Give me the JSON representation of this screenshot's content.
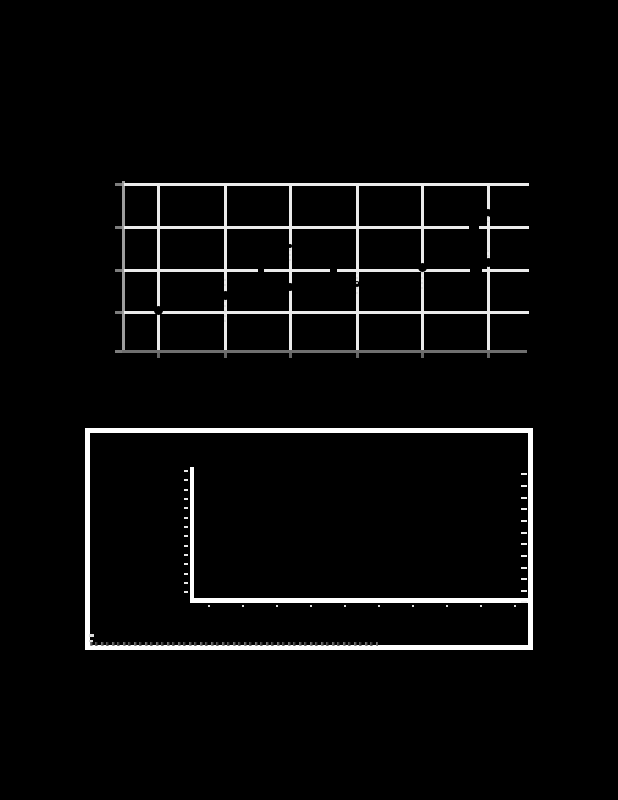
{
  "page": {
    "background": "#000000",
    "width": 618,
    "height": 800,
    "visible_text": "none — all labels are illegible (rendered black on black); only plot graphics are visible"
  },
  "figure1": {
    "name": "top-grid-chart",
    "plot_area": {
      "x": 122,
      "y": 181,
      "w": 405,
      "h": 172
    },
    "colors": {
      "gridline": "#ebebeb",
      "spine_left": "#9e9e9e",
      "spine_bottom": "#6f6f6f",
      "tick_left": "#7d7d7d",
      "tick_bottom": "#666666",
      "marker": "#000000",
      "dash_remnant": "#d8d8d8"
    },
    "h_gridlines_y": [
      183,
      226,
      269,
      311
    ],
    "v_gridlines_x": [
      157,
      224,
      289,
      356,
      421,
      487
    ],
    "left_spine": {
      "x": 122,
      "y": 181,
      "w": 3,
      "h": 172
    },
    "bottom_spine": {
      "x": 122,
      "y": 350,
      "w": 405,
      "h": 3
    },
    "left_ticks_y": [
      183,
      226,
      269,
      311,
      350
    ],
    "bottom_ticks_x": [
      157,
      224,
      289,
      356,
      421,
      487
    ],
    "marker_dots": [
      {
        "x": 158,
        "y": 310,
        "d": 9
      },
      {
        "x": 225,
        "y": 295,
        "d": 9
      },
      {
        "x": 290,
        "y": 287,
        "d": 8
      },
      {
        "x": 290,
        "y": 246,
        "d": 4
      },
      {
        "x": 357,
        "y": 284,
        "d": 6
      },
      {
        "x": 422,
        "y": 267,
        "d": 9
      },
      {
        "x": 488,
        "y": 262,
        "d": 9
      },
      {
        "x": 488,
        "y": 213,
        "d": 8
      }
    ],
    "line_nicks": [
      {
        "x": 469,
        "y": 224,
        "w": 10,
        "h": 5
      },
      {
        "x": 470,
        "y": 267,
        "w": 12,
        "h": 5
      },
      {
        "x": 330,
        "y": 268,
        "w": 7,
        "h": 4
      },
      {
        "x": 258,
        "y": 268,
        "w": 6,
        "h": 4
      }
    ],
    "white_dash_segments": [
      {
        "x": 224,
        "y1": 279,
        "y2": 288
      },
      {
        "x": 224,
        "y1": 300,
        "y2": 322
      },
      {
        "x": 289,
        "y1": 249,
        "y2": 262
      },
      {
        "x": 356,
        "y1": 272,
        "y2": 296
      },
      {
        "x": 421,
        "y1": 272,
        "y2": 290
      },
      {
        "x": 487,
        "y1": 250,
        "y2": 258
      },
      {
        "x": 487,
        "y1": 216,
        "y2": 222
      }
    ]
  },
  "figure2": {
    "name": "bottom-empty-axes-figure",
    "frame": {
      "x": 85,
      "y": 428,
      "w": 448,
      "h": 222,
      "border_px": 5,
      "color": "#ffffff"
    },
    "y_axis": {
      "x": 190,
      "y": 467,
      "w": 4,
      "h": 136,
      "color": "#ffffff"
    },
    "x_axis": {
      "x": 190,
      "y": 598,
      "w": 338,
      "h": 5,
      "color": "#ffffff"
    },
    "y_tick_dashes": {
      "x": 184,
      "w": 4,
      "h": 2,
      "color": "#e8e8e8",
      "ys": [
        470,
        479,
        489,
        498,
        507,
        517,
        526,
        535,
        545,
        554,
        563,
        573,
        582,
        591
      ]
    },
    "x_tick_dots": {
      "y": 605,
      "w": 2,
      "h": 2,
      "color": "#dddddd",
      "xs": [
        208,
        242,
        276,
        310,
        344,
        378,
        412,
        446,
        480,
        514
      ]
    },
    "right_tick_dashes": {
      "x": 521,
      "w": 6,
      "h": 2,
      "color": "#f0f0f0",
      "ys": [
        473,
        485,
        497,
        508,
        520,
        532,
        543,
        555,
        567,
        578,
        590,
        601
      ]
    },
    "caption_speckle_strip": {
      "x": 90,
      "y": 642,
      "w": 288,
      "h": 4,
      "note": "illegible degraded caption text remnants"
    },
    "left_edge_marks": [
      {
        "x": 89,
        "y": 634,
        "w": 5,
        "h": 3
      },
      {
        "x": 89,
        "y": 640,
        "w": 4,
        "h": 2
      }
    ]
  },
  "chart_data": [
    {
      "type": "scatter",
      "title": "",
      "xlabel": "",
      "ylabel": "",
      "note": "Top figure: white grid on black; axis tick labels not visible (black on black). Values estimated in grid units (bottom spine = 0, one unit per horizontal gridline; columns 1-6 at vertical gridlines).",
      "x": [
        1,
        2,
        3,
        3,
        4,
        5,
        6,
        6
      ],
      "y": [
        0.97,
        1.35,
        1.54,
        2.53,
        1.61,
        2.01,
        2.13,
        3.31
      ],
      "xlim": [
        0.5,
        6.6
      ],
      "ylim": [
        0,
        4
      ],
      "grid": true,
      "legend": false,
      "labels_visible": false
    },
    {
      "type": "line",
      "title": "",
      "xlabel": "",
      "ylabel": "",
      "series": [],
      "note": "Bottom figure: empty framed axes (L-shaped white axis with ~14 y-ticks, ~10 x-ticks, ~12 right-edge ticks); no visible data; caption line illegible.",
      "grid": false,
      "legend": false,
      "labels_visible": false
    }
  ]
}
